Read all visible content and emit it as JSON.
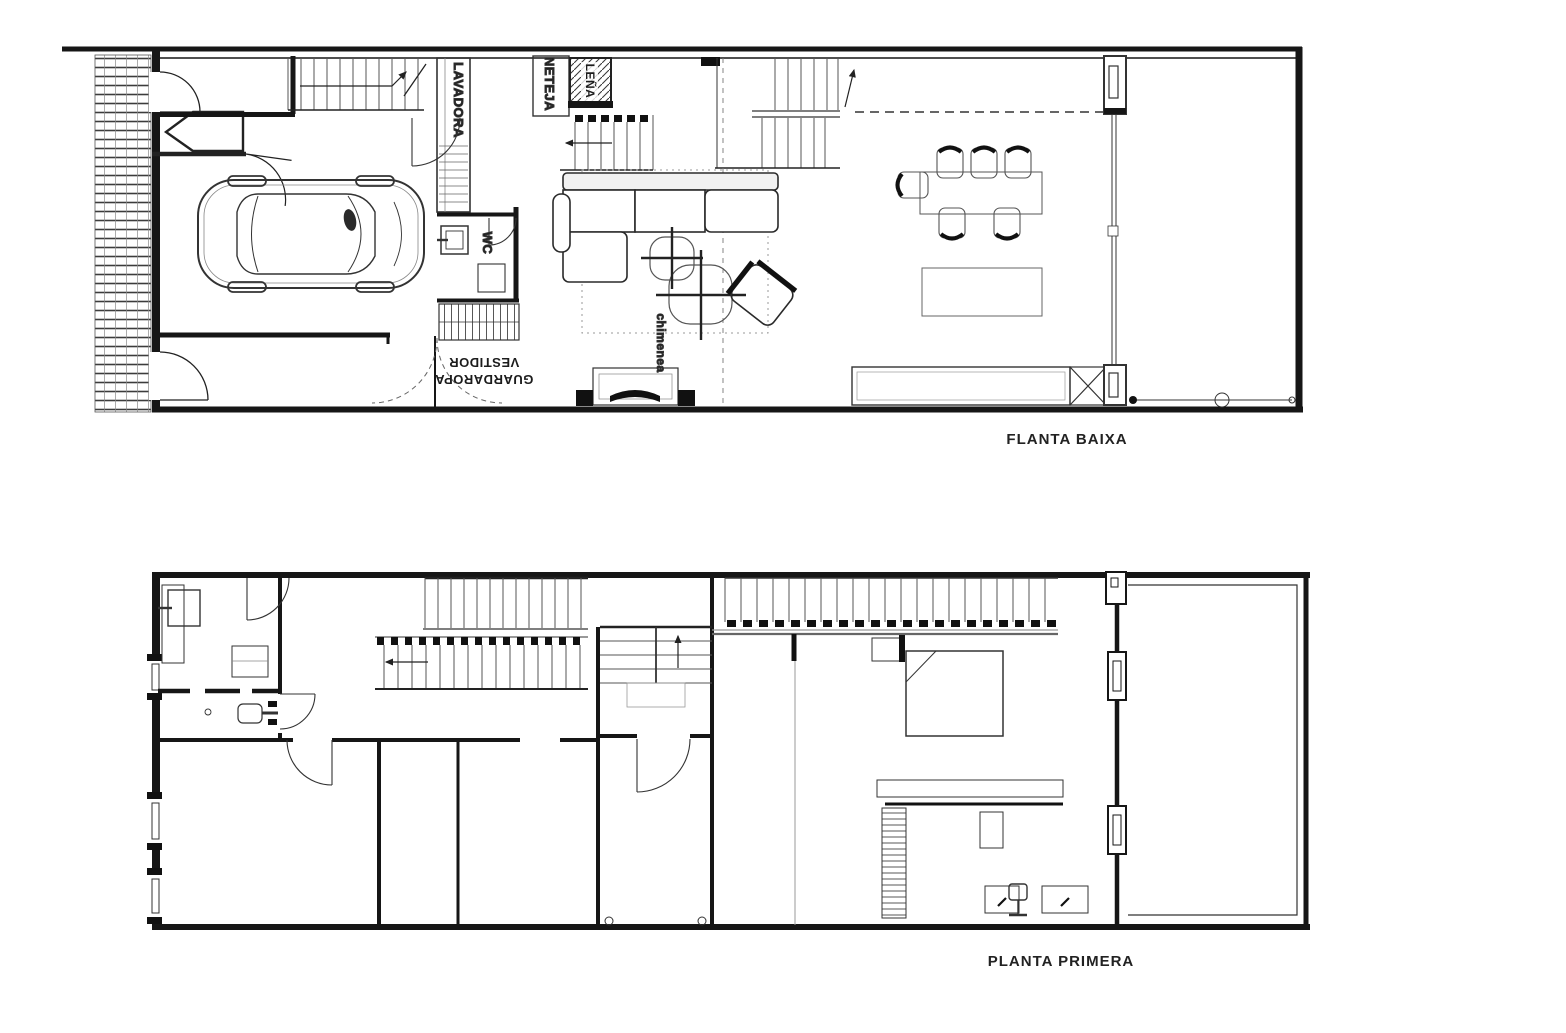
{
  "document": {
    "kind": "architectural floor plan sheet",
    "colors": {
      "ink": "#1c1c1c",
      "mid": "#444444",
      "light": "#8a8a8a",
      "background": "#ffffff"
    }
  },
  "ground_floor": {
    "caption": "FLANTA BAIXA",
    "labels": {
      "lavadora": "LAVADORA",
      "neteja": "NETEJA",
      "lena": "LEÑA",
      "wc": "WC",
      "guardaropa": "GUARDAROPA",
      "vestidor": "VESTIDOR",
      "chimenea": "chimenea"
    }
  },
  "first_floor": {
    "caption": "PLANTA PRIMERA"
  }
}
